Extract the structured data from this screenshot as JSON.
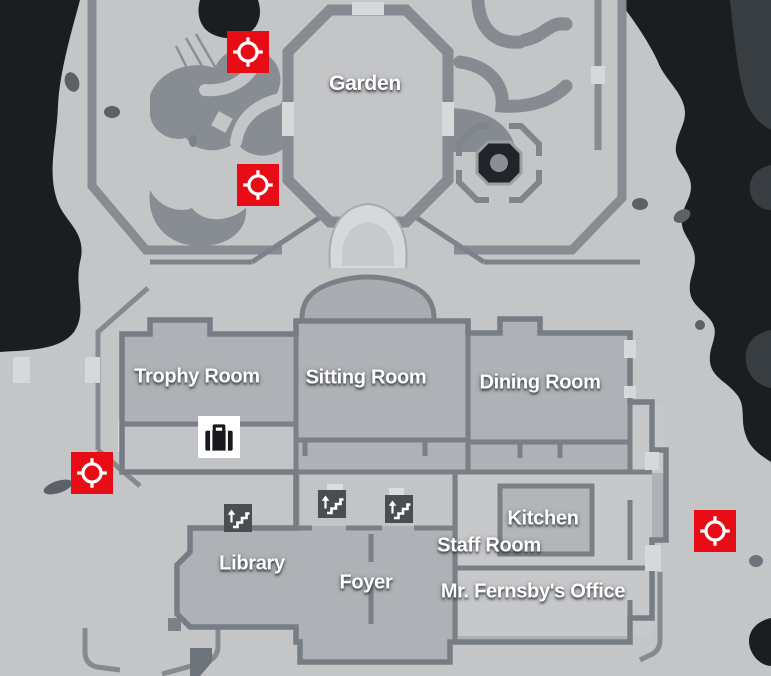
{
  "rooms": {
    "garden": "Garden",
    "trophy": "Trophy Room",
    "sitting": "Sitting Room",
    "dining": "Dining Room",
    "kitchen": "Kitchen",
    "staff": "Staff Room",
    "library": "Library",
    "foyer": "Foyer",
    "office": "Mr. Fernsby's Office"
  },
  "icons": {
    "target": "target-crosshair-icon",
    "briefcase": "briefcase-icon",
    "stairs": "stairs-up-icon",
    "fountain": "fountain-icon"
  },
  "markers": {
    "target_count": 4,
    "stairs_count": 3,
    "briefcase_count": 1
  },
  "colors": {
    "marker_red": "#e80c17",
    "void": "#1b1d20",
    "void_light": "#383d42",
    "terrain": "#c3c5c7",
    "hedge": "#858b90",
    "path_light": "#d6d8da",
    "room_floor": "#aeb1b5",
    "room_floor_light": "#c6c8ca",
    "wall": "#798086",
    "stairs_bg": "#4a4e52",
    "glyph_dark": "#17191c",
    "label": "#ffffff"
  }
}
